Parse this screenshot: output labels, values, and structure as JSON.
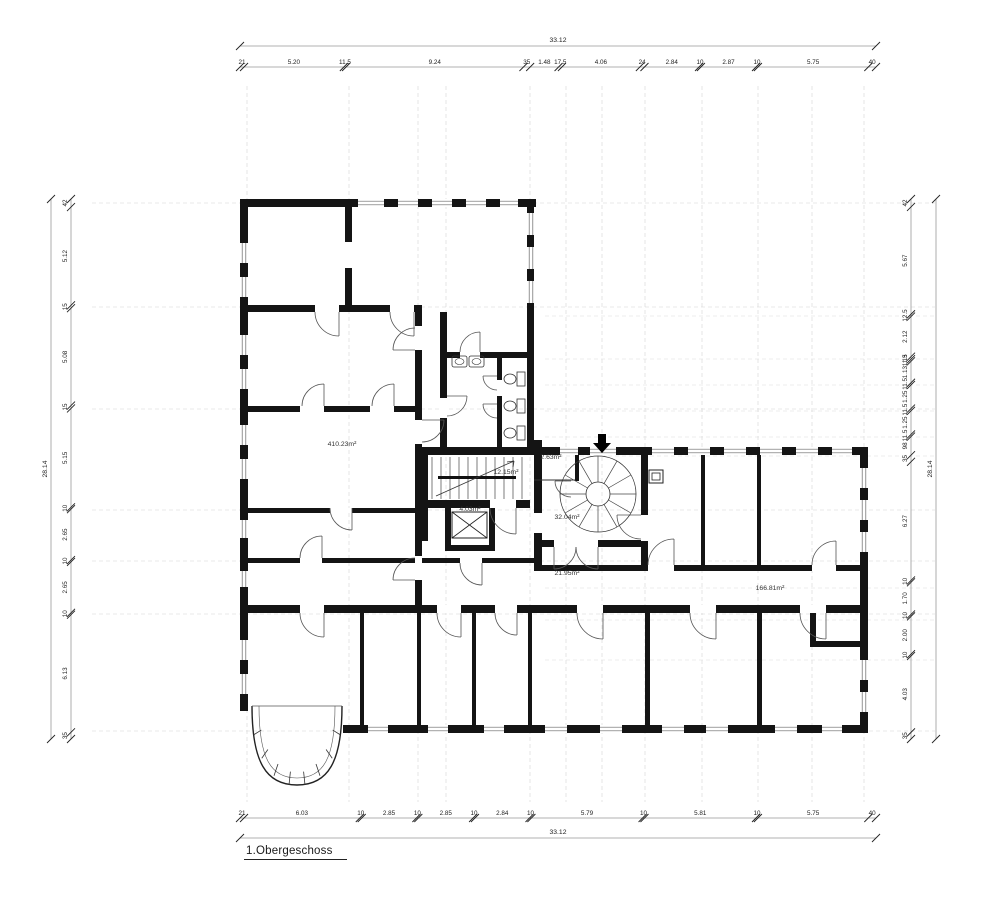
{
  "title": "1.Obergeschoss",
  "dimensions": {
    "top": {
      "overall": "33.12",
      "segments": [
        "21",
        "5.20",
        "11.5",
        "9.24",
        "35",
        "1.48",
        "17.5",
        "4.06",
        "24",
        "2.84",
        "10",
        "2.87",
        "10",
        "5.75",
        "40"
      ]
    },
    "bottom": {
      "overall": "33.12",
      "segments": [
        "21",
        "6.03",
        "10",
        "2.85",
        "10",
        "2.85",
        "10",
        "2.84",
        "10",
        "5.79",
        "10",
        "5.81",
        "10",
        "5.75",
        "40"
      ]
    },
    "left": {
      "overall": "28.14",
      "segments": [
        "42",
        "5.12",
        "15",
        "5.08",
        "15",
        "5.15",
        "10",
        "2.65",
        "10",
        "2.65",
        "10",
        "6.13",
        "35"
      ]
    },
    "right": {
      "overall": "28.14",
      "segments": [
        "42",
        "5.67",
        "12.5",
        "2.12",
        "13",
        "11.5",
        "1.13",
        "11.5",
        "1.25",
        "11.5",
        "1.25",
        "11.5",
        "98",
        "35",
        "6.27",
        "10",
        "1.70",
        "10",
        "2.00",
        "10",
        "4.03",
        "35"
      ]
    }
  },
  "rooms": [
    {
      "area": "410.23m²"
    },
    {
      "area": "12.15m²"
    },
    {
      "area": "2.63m²"
    },
    {
      "area": "4.03m²"
    },
    {
      "area": "32.04m²"
    },
    {
      "area": "21.95m²"
    },
    {
      "area": "166.81m²"
    }
  ]
}
